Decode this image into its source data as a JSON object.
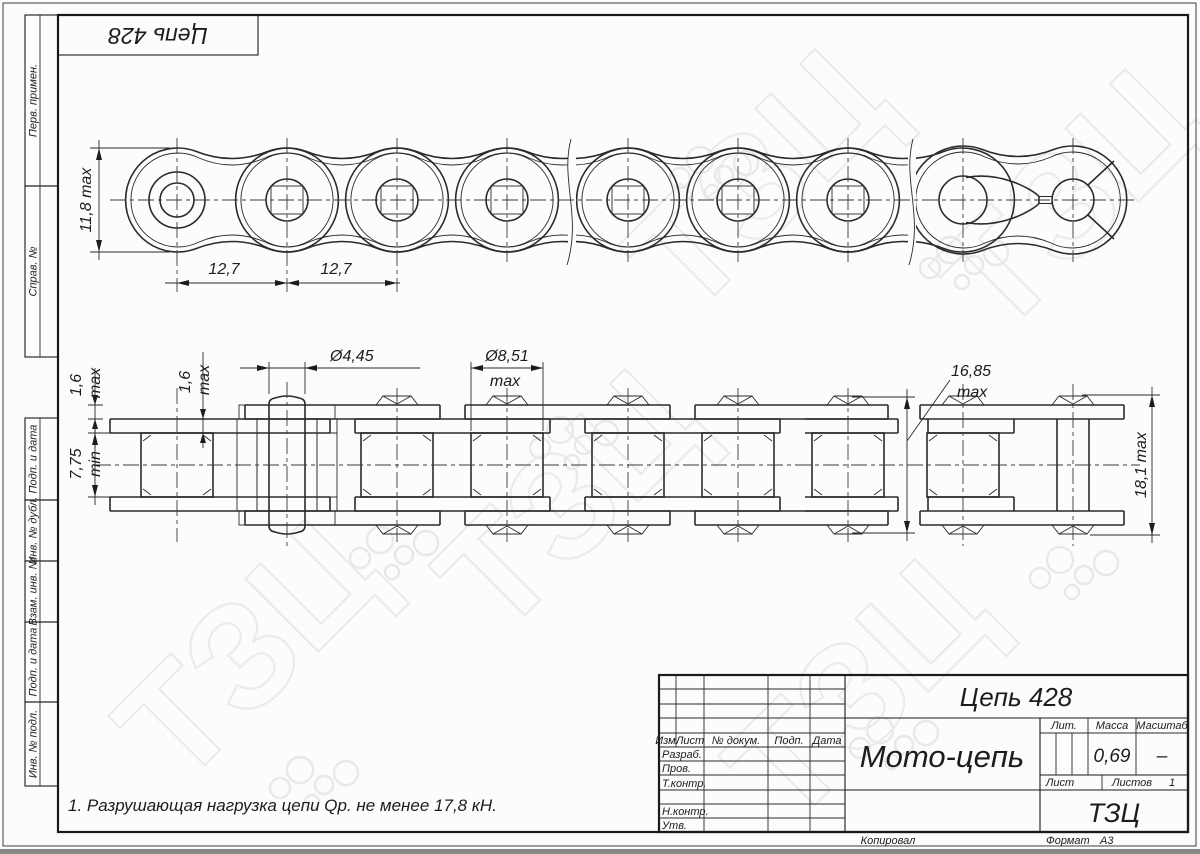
{
  "sheet": {
    "corner_stamp": "Цепь 428",
    "margin_labels": [
      "Перв. примен.",
      "Справ. №",
      "Подп. и дата",
      "Инв. № дубл.",
      "Взам. инв. №",
      "Подп. и дата",
      "Инв. № подл."
    ],
    "note": "1. Разрушающая нагрузка цепи Qр. не менее 17,8 кН."
  },
  "dims": {
    "top": {
      "width": "11,8 max",
      "pitch_1": "12,7",
      "pitch_2": "12,7"
    },
    "side": {
      "outer_plate": "1,6",
      "outer_plate_sfx": "max",
      "inner_plate": "1,6",
      "inner_plate_sfx": "max",
      "inner_width": "7,75",
      "inner_width_sfx": "min",
      "pin_d": "Ø4,45",
      "roller_d": "Ø8,51",
      "roller_d_sfx": "max",
      "pin_len": "16,85",
      "pin_len_sfx": "max",
      "lock_width": "18,1 max"
    }
  },
  "title_block": {
    "doc_number": "Цепь 428",
    "name": "Мото-цепь",
    "org": "ТЗЦ",
    "col_izm": "Изм.",
    "col_list": "Лист",
    "col_doc": "№ докум.",
    "col_podp": "Подп.",
    "col_data": "Дата",
    "row_razrab": "Разраб.",
    "row_prov": "Пров.",
    "row_tkontr": "Т.контр.",
    "row_nkontr": "Н.контр.",
    "row_utv": "Утв.",
    "lit": "Лит.",
    "massa": "Масса",
    "masshtab": "Масштаб",
    "massa_value": "0,69",
    "masshtab_value": "–",
    "list": "Лист",
    "listov": "Листов",
    "listov_value": "1"
  },
  "footer": {
    "copied": "Копировал",
    "format": "Формат",
    "format_value": "А3"
  }
}
